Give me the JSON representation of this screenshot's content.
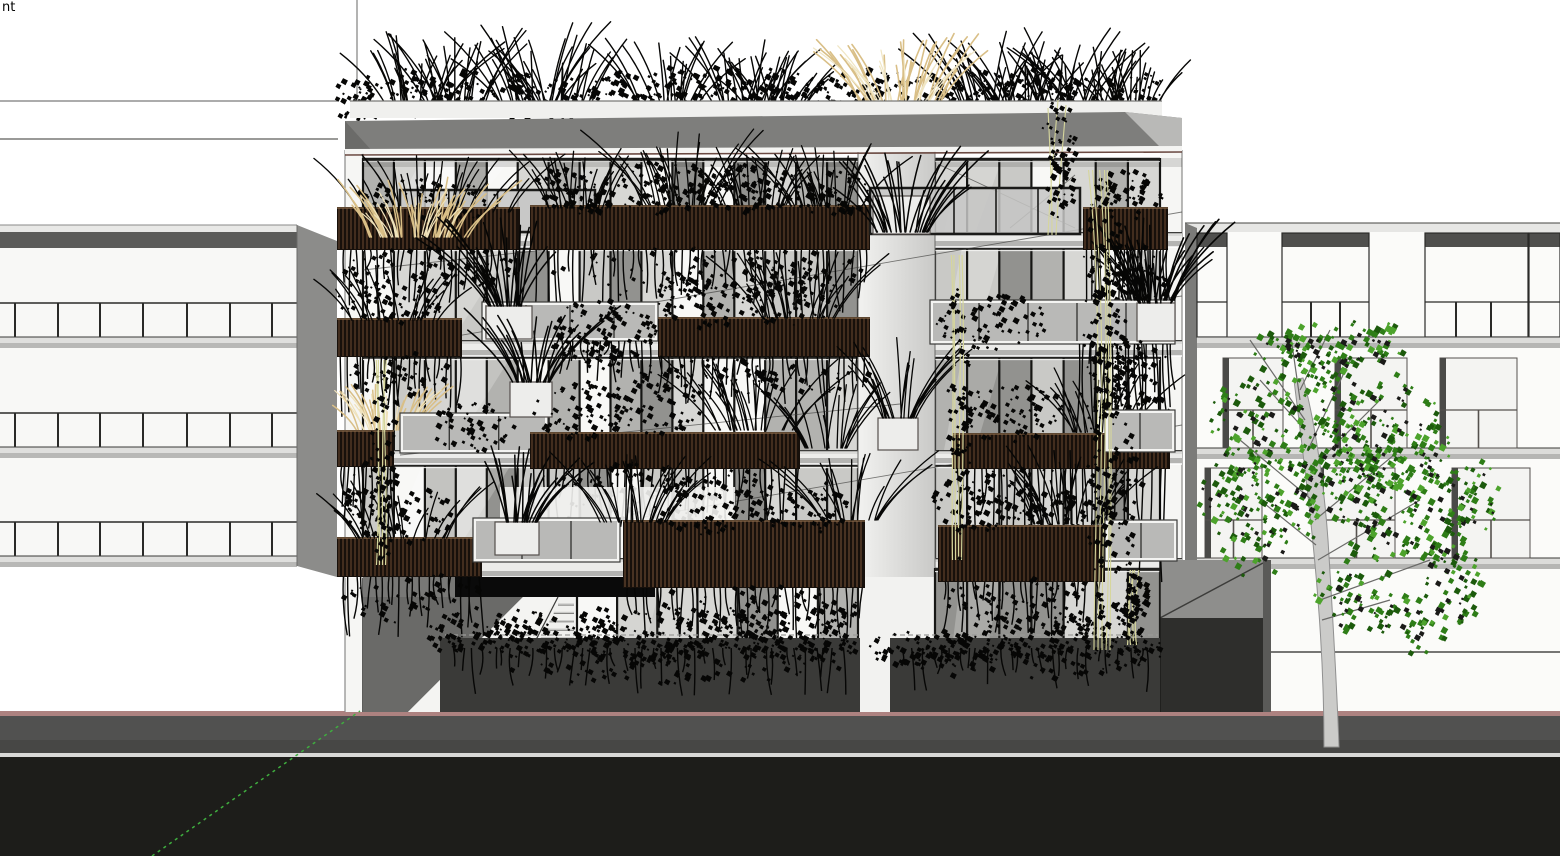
{
  "viewport": {
    "view_label_partial": "nt",
    "kind": "3d-architectural-model-viewport"
  },
  "scene": {
    "description": "Front elevation render of a five-storey apartment building with planted balconies and roof garden, flanked by two neighbouring buildings, a street tree, sidewalk and road",
    "center_building": {
      "glazed_floors": 4,
      "has_ground_floor": true,
      "has_roof_garden": true,
      "planter_rows": 4,
      "has_entrance_stairs": true
    },
    "left_building_window_rows": 3,
    "right_building_floors": 4,
    "street_tree": true,
    "axis_guide_line": "dashed-green"
  },
  "palette": {
    "sky": "#ffffff",
    "road": "#1d1d1a",
    "sidewalk": "#515150",
    "sidewalk_dark": "#474745",
    "curb": "#d9d9d7",
    "accent_rose": "#ad8280",
    "fascia": "#7e7e7c",
    "fascia_line": "#6b4a42",
    "parapet": "#f0f0ee",
    "wall": "#f6f6f4",
    "glass_light": "#c9c9c7",
    "glass_mid": "#b1b1af",
    "glass_dark": "#8f8f8d",
    "pane_white": "#fbfbfa",
    "mullion": "#161614",
    "planter_dark": "#17100b",
    "planter_slat": "#6a4830",
    "plant_black": "#060605",
    "grass_tan": "#d9bf87",
    "grass_tan_light": "#efe2bb",
    "vine_stem": "#d6d69c",
    "tree_leaf": "#2e7d17",
    "tree_leaf_dark": "#1c5a0c",
    "tree_leaf_light": "#4da32c",
    "tree_trunk": "#cbcbc9",
    "tree_trunk_edge": "#909090",
    "neighbor_header": "#4f4f4d",
    "neighbor_side": "#8c8c8a",
    "axis_green": "#3fae3f",
    "hedge_wall": "#3a3a38",
    "entry_shadow": "#0a0a0a"
  }
}
